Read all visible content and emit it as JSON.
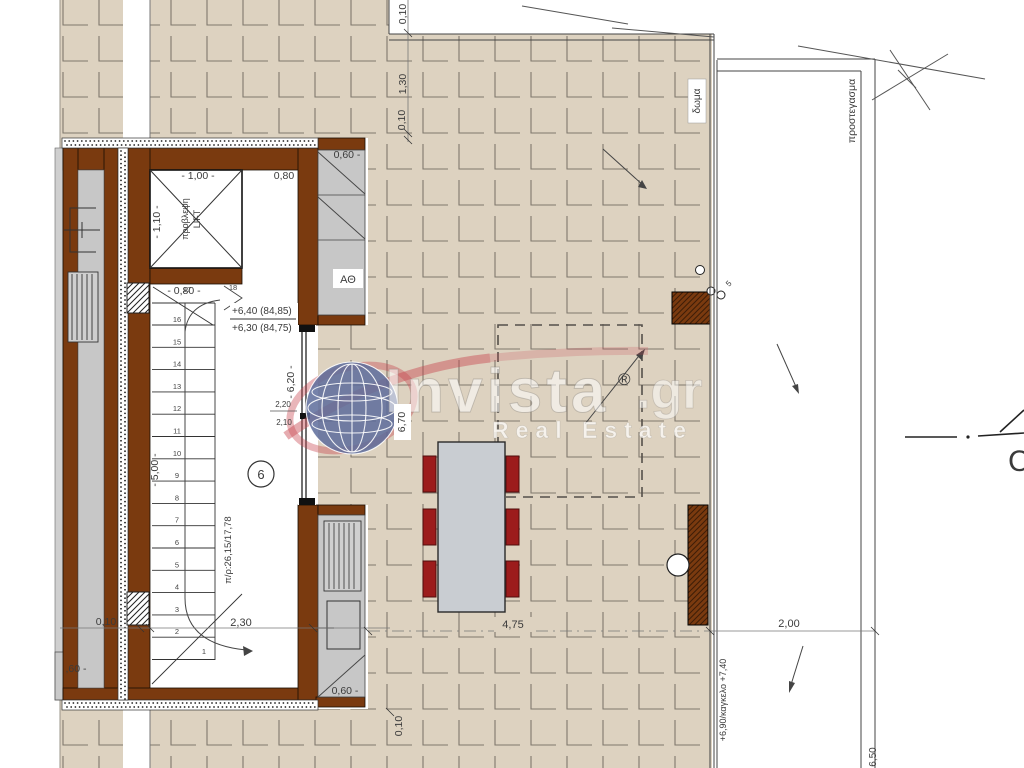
{
  "watermark": {
    "brand": "Invista",
    "tld": ".gr",
    "registered": "®",
    "tagline": "Real Estate"
  },
  "core": {
    "lift_line1": "προβλεψη",
    "lift_line2": "LIFT",
    "dim_lift_width": "- 1,00 -",
    "dim_lift_right": "0,80",
    "dim_lift_height": "- 1,10 -",
    "dim_landing": "- 0,80 -",
    "level_top": "+6,40 (84,85)",
    "level_bottom": "+6,30 (84,75)",
    "dim_stair_height": "- 6,20 -",
    "dim_2_20": "2,20",
    "dim_2_10": "2,10",
    "floor_number": "6",
    "tread_riser": "π/ρ:26,15/17,78",
    "dim_flight": "- 5,00 -",
    "dim_2_30": "2,30",
    "dim_0_10": "0,10",
    "dim_0_60": ",60 -",
    "stair_numbers": [
      "1",
      "2",
      "3",
      "4",
      "5",
      "6",
      "7",
      "8",
      "9",
      "10",
      "11",
      "12",
      "13",
      "14",
      "15",
      "16",
      "17",
      "18"
    ]
  },
  "closet": {
    "dim": "0,60 -",
    "label": "ΑΘ"
  },
  "kitchen": {
    "dim": "0,60 -",
    "dim_side": "0,10"
  },
  "terrace": {
    "dim_top_a": "0,10",
    "dim_top_b": "1,30",
    "dim_top_c": "0,10",
    "dim_width": "6,70",
    "dim_table": "4,75",
    "dim_canopy": "2,00",
    "roof_label": "δωμα",
    "canopy_label": "προστεγασμα",
    "railing_label": "+6,90/καγκελο +7,40",
    "dim_right": "6,50",
    "vent_dim": "5",
    "section_letter": "C"
  }
}
